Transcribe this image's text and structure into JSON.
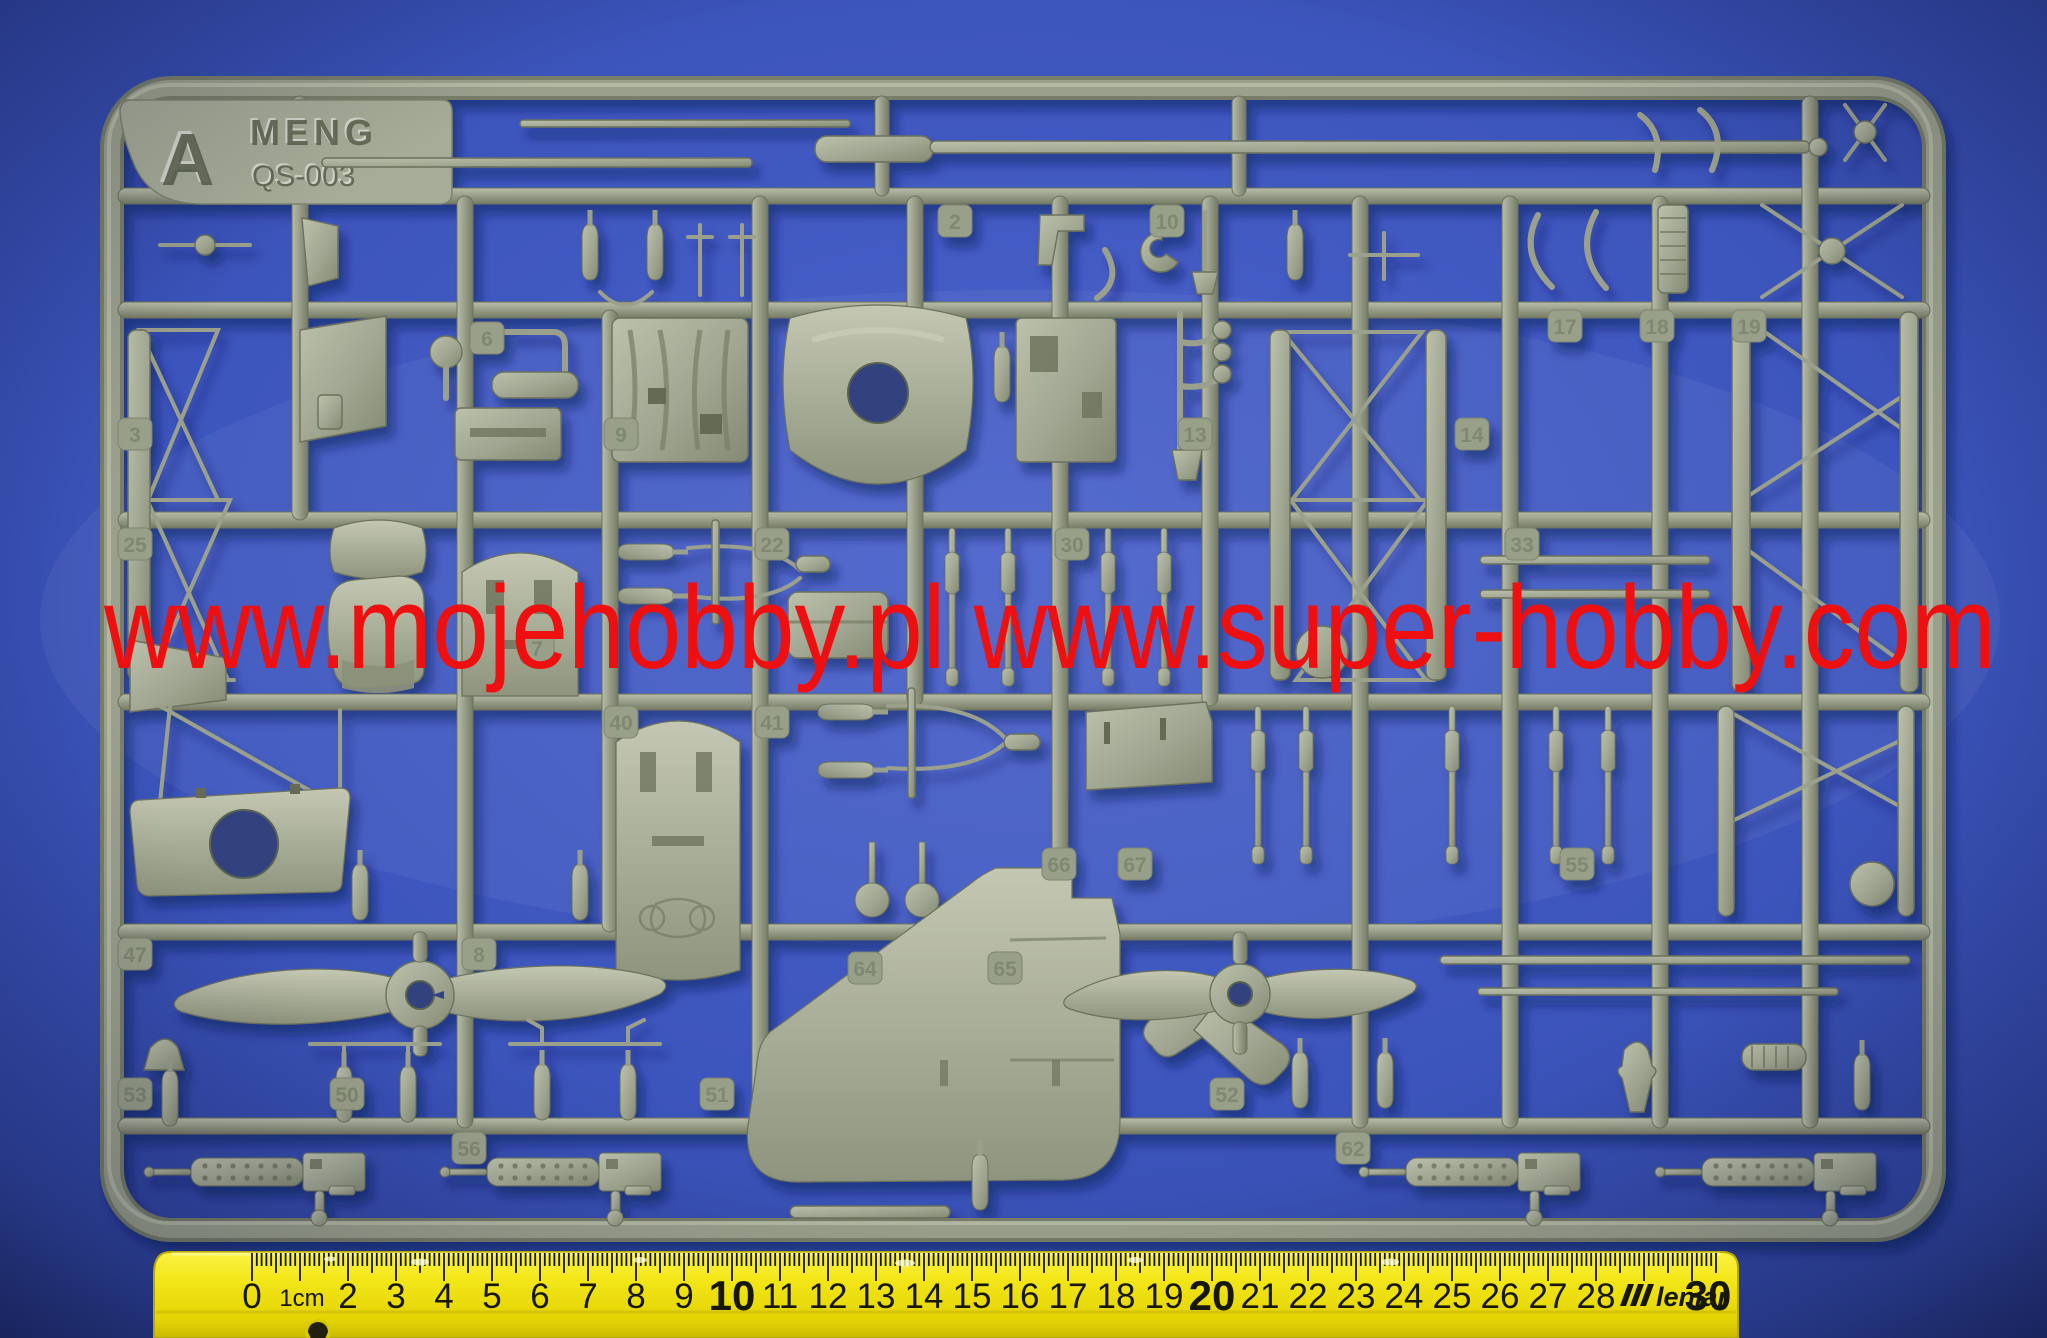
{
  "photo": {
    "subject": "model kit sprue on blue background with ruler"
  },
  "sprue": {
    "tag_letter": "A",
    "brand": "MENG",
    "kit_code": "QS-003",
    "color": "#9aa08c",
    "part_tabs": [
      "2",
      "3",
      "6",
      "7",
      "8",
      "9",
      "10",
      "13",
      "14",
      "17",
      "18",
      "19",
      "22",
      "25",
      "30",
      "33",
      "40",
      "41",
      "47",
      "50",
      "51",
      "52",
      "53",
      "55",
      "56",
      "62",
      "64",
      "65",
      "66",
      "67"
    ]
  },
  "watermark": {
    "text": "www.mojehobby.pl www.super-hobby.com",
    "color": "#ee1010"
  },
  "ruler": {
    "labels": [
      "0",
      "1cm",
      "2",
      "3",
      "4",
      "5",
      "6",
      "7",
      "8",
      "9",
      "10",
      "11",
      "12",
      "13",
      "14",
      "15",
      "16",
      "17",
      "18",
      "19",
      "20",
      "21",
      "22",
      "23",
      "24",
      "25",
      "26",
      "27",
      "28",
      "30"
    ],
    "brand": "leniar",
    "unit": "cm",
    "length_cm": 30,
    "color": "#f3e71a"
  },
  "background": {
    "color": "#3c55bd"
  }
}
